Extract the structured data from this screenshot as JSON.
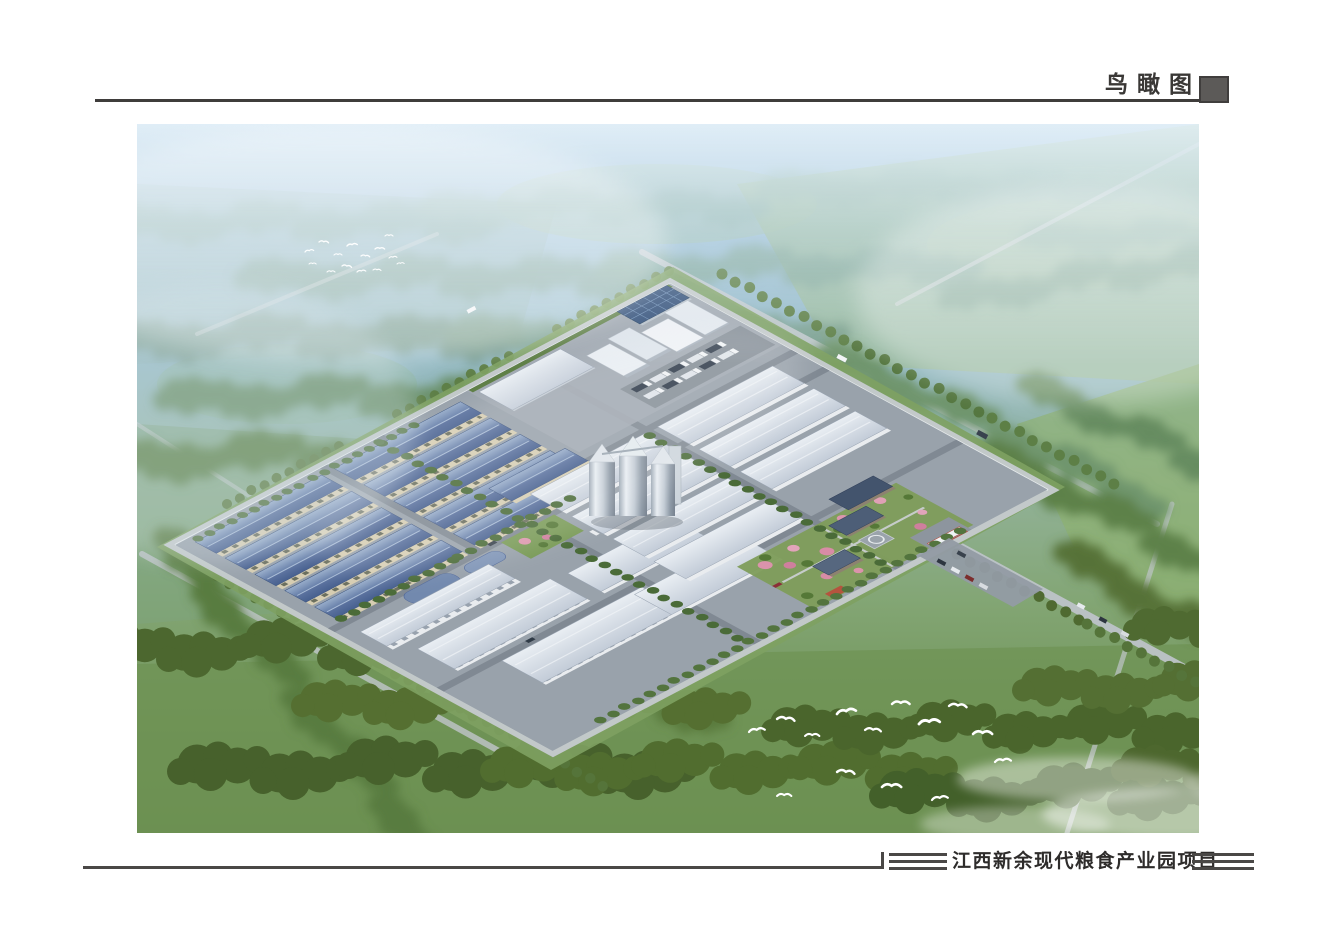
{
  "sheet": {
    "header": {
      "label": "鸟瞰图",
      "marker_icon": "filled-square"
    },
    "footer": {
      "title": "江西新余现代粮食产业园项目"
    }
  },
  "figure": {
    "kind": "aerial-birdseye-rendering-of-grain-industrial-park",
    "colors": {
      "sky_haze": "#a9c9df",
      "mist": "#e6f2fa",
      "distant_forest": "#86aca6",
      "field_green": "#6f9355",
      "forest_green": "#4c672f",
      "park_ground": "#99a2ab",
      "blue_roof": "#5a719e",
      "cream_wall": "#d6cdb2",
      "white_building": "#e9eef3",
      "office_roof": "#43546d",
      "accent_pink_trees": "#db93ab",
      "gate_red": "#b44a3c",
      "rule_gray": "#4a4846",
      "marker_gray": "#5c5a58",
      "birds": "#ffffff"
    }
  }
}
